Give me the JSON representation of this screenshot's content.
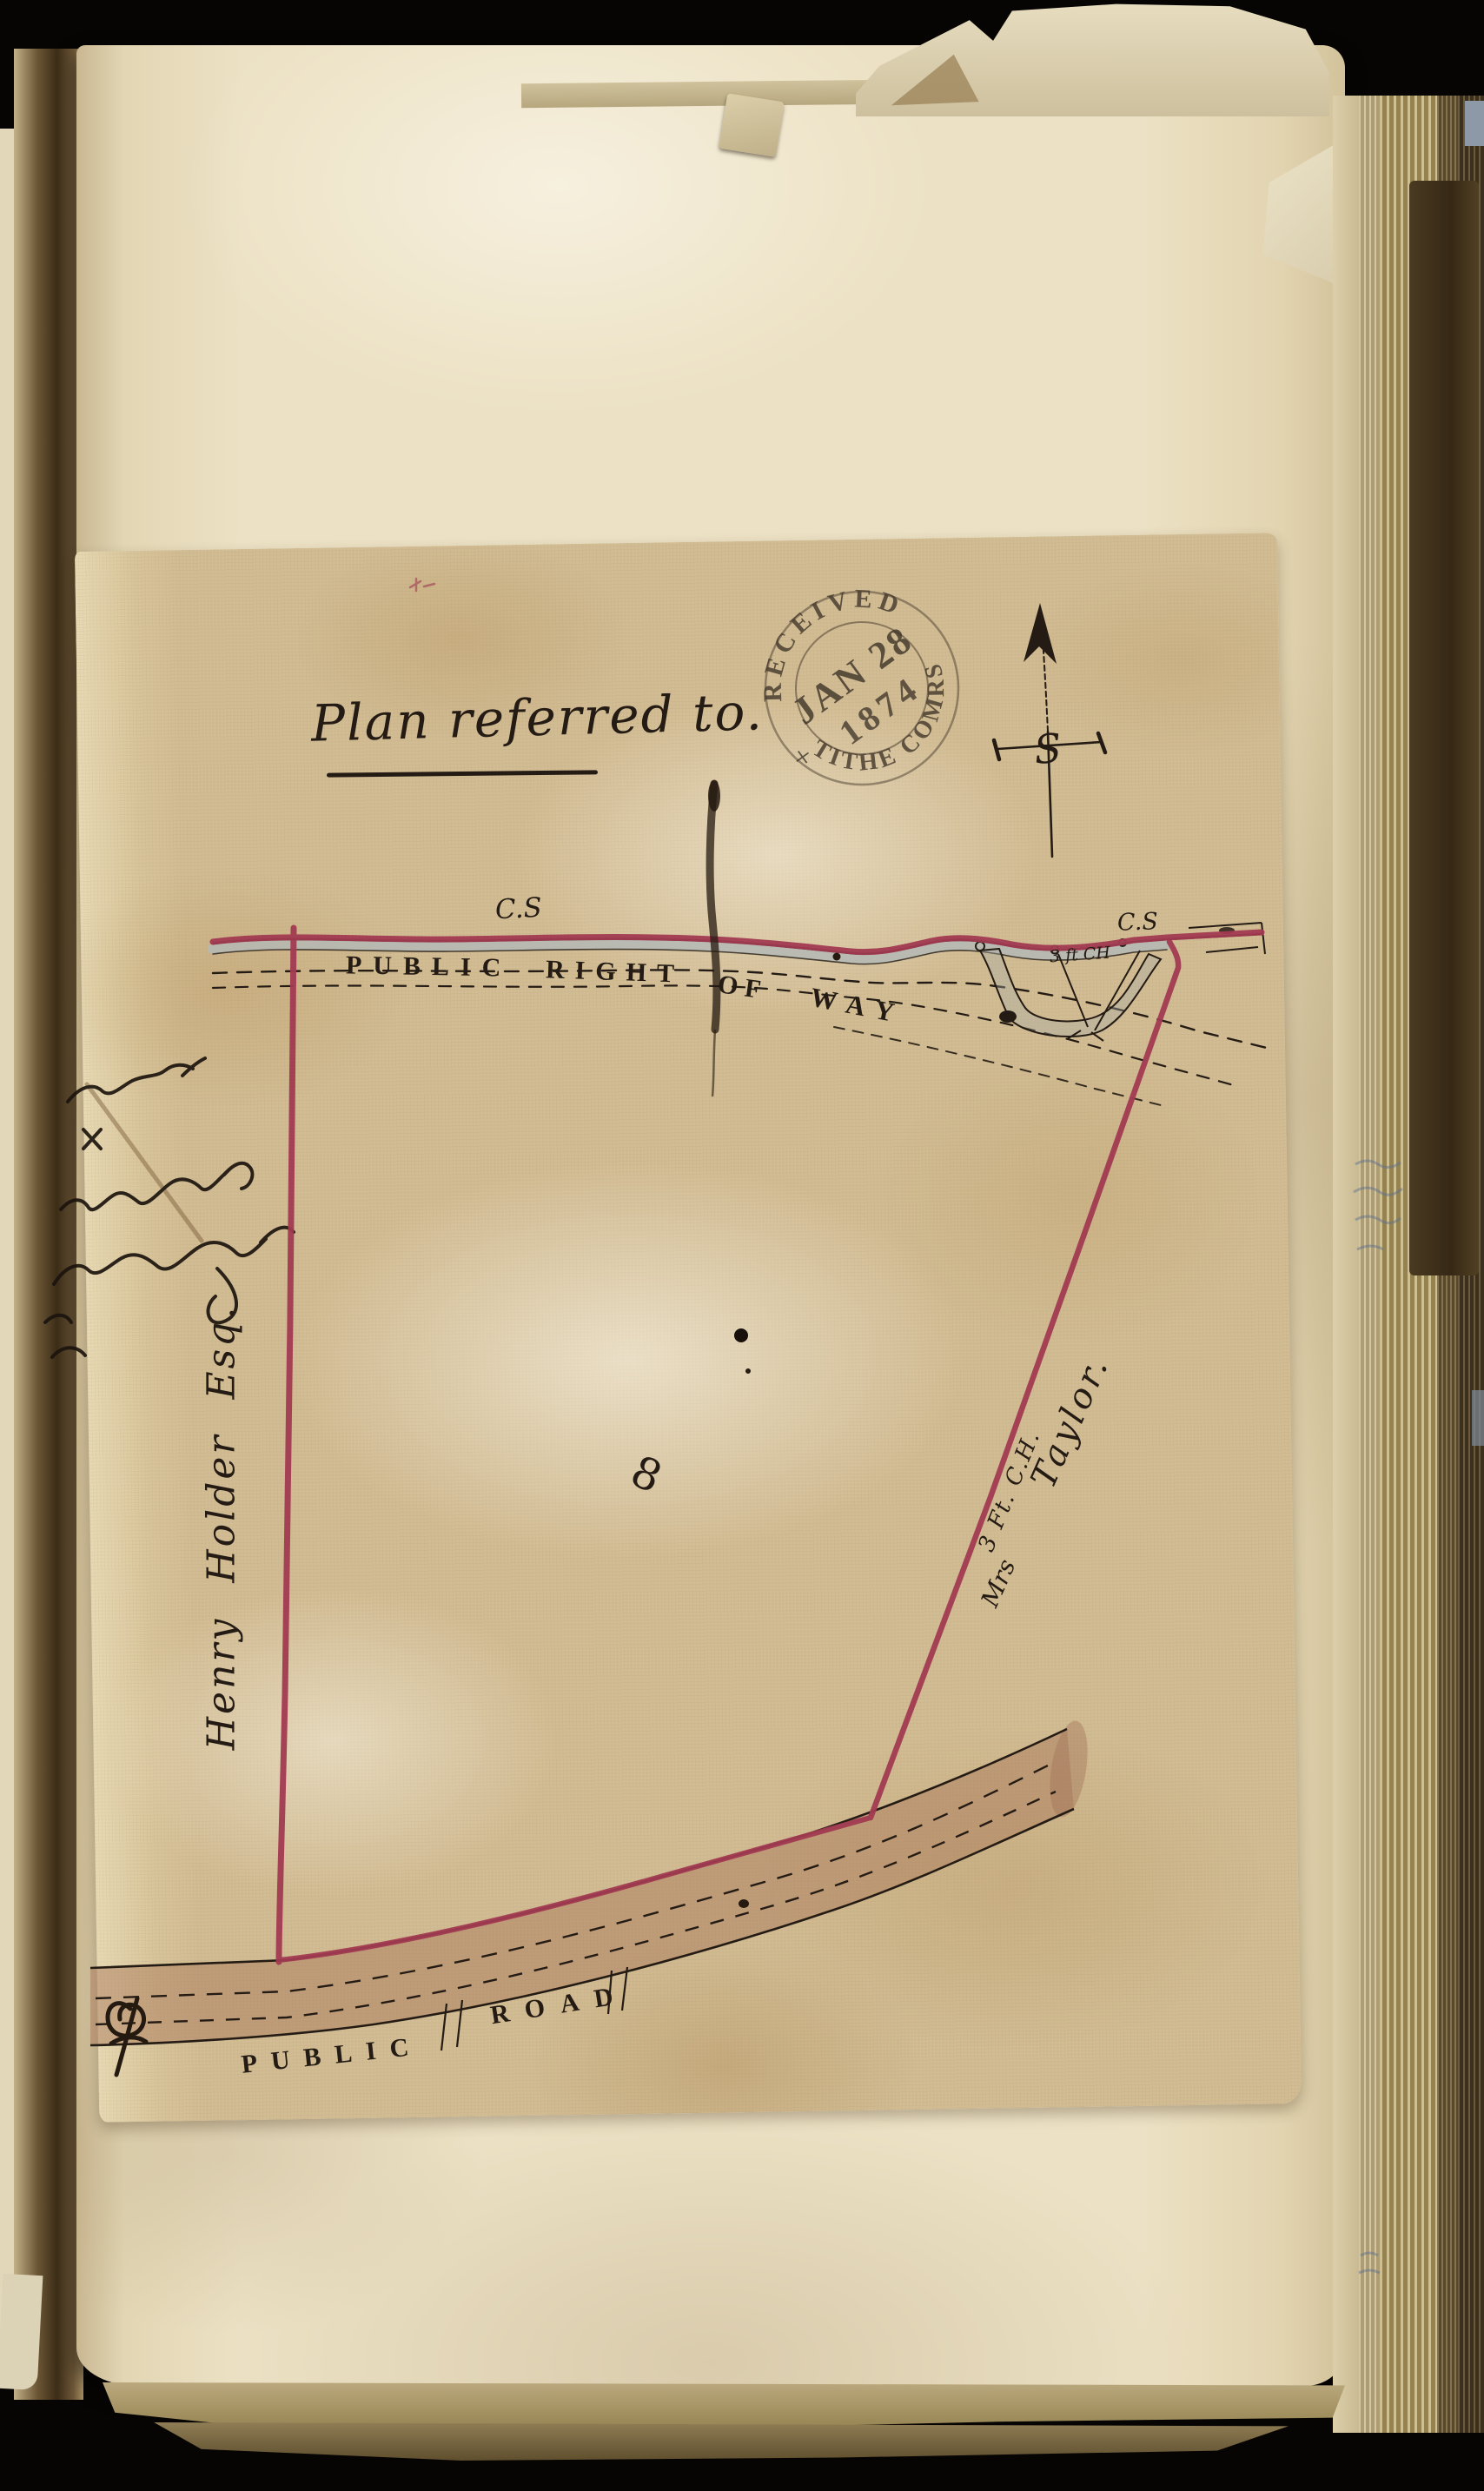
{
  "page": {
    "title": "Plan referred to.",
    "stamp": {
      "top_arc": "RECEIVED",
      "cross": "+",
      "date_line": "JAN 28",
      "year_line": "1874",
      "bottom_arc": "TITHE COMRS"
    },
    "compass": {
      "center_letter": "S"
    },
    "plan": {
      "cs_label_left": "C.S",
      "cs_label_right": "C.S",
      "right_of_way_words": [
        "PUBLIC",
        "RIGHT",
        "OF",
        "WAY"
      ],
      "gate_note": "3 ft CH",
      "parcel_number": "8",
      "left_owner": "Henry Holder Esq.",
      "right_owner_prefix": "Mrs",
      "right_boundary_note": "3 Ft. C.H.",
      "right_owner_name": "Taylor.",
      "road_words": [
        "PUBLIC",
        "ROAD"
      ]
    },
    "marginalia": {
      "signatures_legible": false
    },
    "palette": {
      "boundary_red": "#a23a52",
      "ink": "#241c14",
      "sheet_tan": "#d2bc93",
      "page_cream": "#ece1c4",
      "stamp_ink": "#4a3e30"
    }
  }
}
